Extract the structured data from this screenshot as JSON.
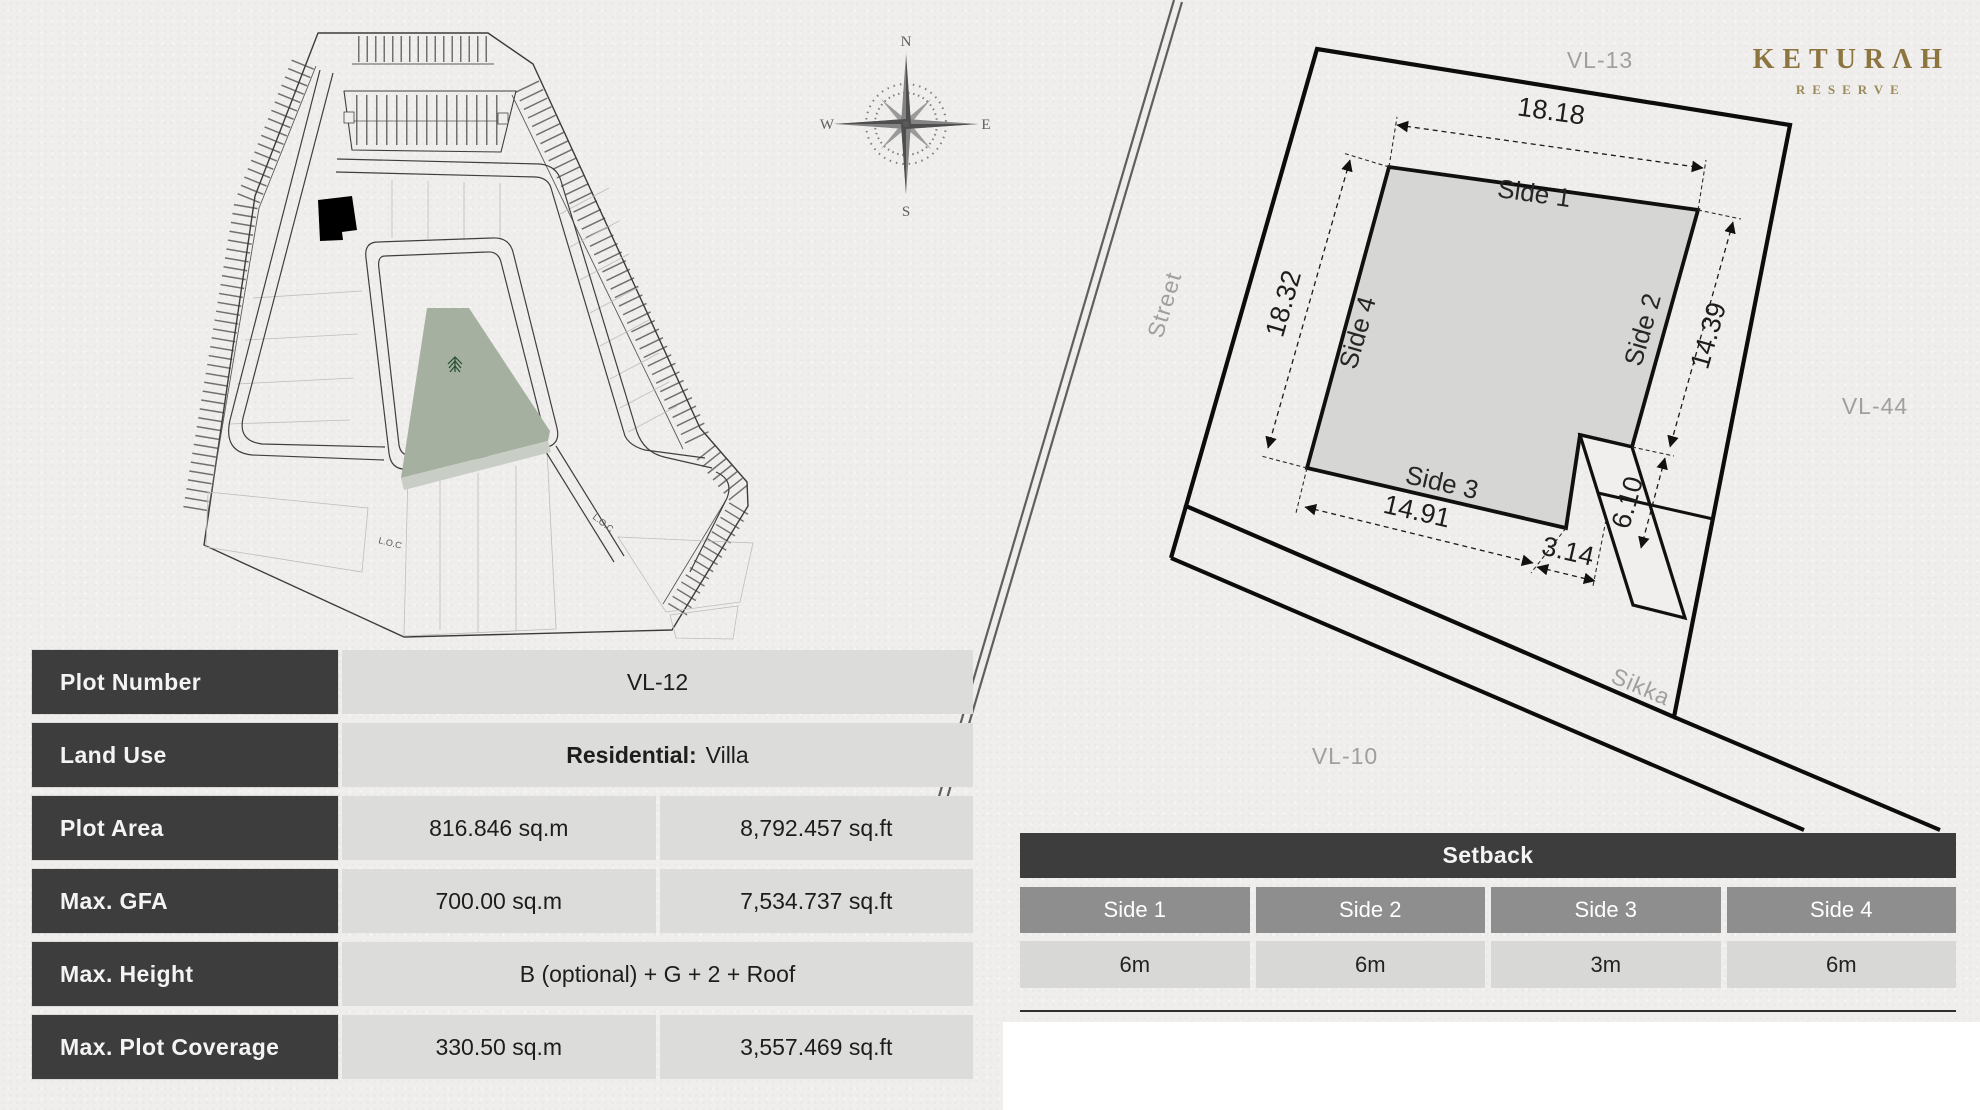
{
  "brand": {
    "name": "KETURAH",
    "display": "KETURΛH",
    "subtitle": "RESERVE",
    "color": "#8d7540"
  },
  "compass": {
    "north": "N",
    "east": "E",
    "south": "S",
    "west": "W"
  },
  "site_map": {
    "loc_label": "L.O.C"
  },
  "plot_diagram": {
    "neighbors": {
      "top": "VL-13",
      "right": "VL-44",
      "bottom": "VL-10"
    },
    "street_label": "Street",
    "sikka_label": "Sikka",
    "sides": {
      "side1": "Side 1",
      "side2": "Side 2",
      "side3": "Side 3",
      "side4": "Side 4"
    },
    "dimensions": {
      "side1": "18.18",
      "side2": "14.39",
      "side3": "14.91",
      "side4": "18.32",
      "notch_width": "3.14",
      "notch_depth": "6.10"
    }
  },
  "info_table": {
    "rows": [
      {
        "label": "Plot Number",
        "value": "VL-12"
      },
      {
        "label": "Land Use",
        "value_bold": "Residential:",
        "value": "Villa"
      },
      {
        "label": "Plot Area",
        "sqm": "816.846 sq.m",
        "sqft": "8,792.457 sq.ft"
      },
      {
        "label": "Max. GFA",
        "sqm": "700.00 sq.m",
        "sqft": "7,534.737 sq.ft"
      },
      {
        "label": "Max. Height",
        "value": "B (optional) + G + 2 + Roof"
      },
      {
        "label": "Max. Plot Coverage",
        "sqm": "330.50 sq.m",
        "sqft": "3,557.469 sq.ft"
      }
    ]
  },
  "setback_table": {
    "title": "Setback",
    "columns": [
      "Side 1",
      "Side 2",
      "Side 3",
      "Side 4"
    ],
    "values": [
      "6m",
      "6m",
      "3m",
      "6m"
    ]
  }
}
